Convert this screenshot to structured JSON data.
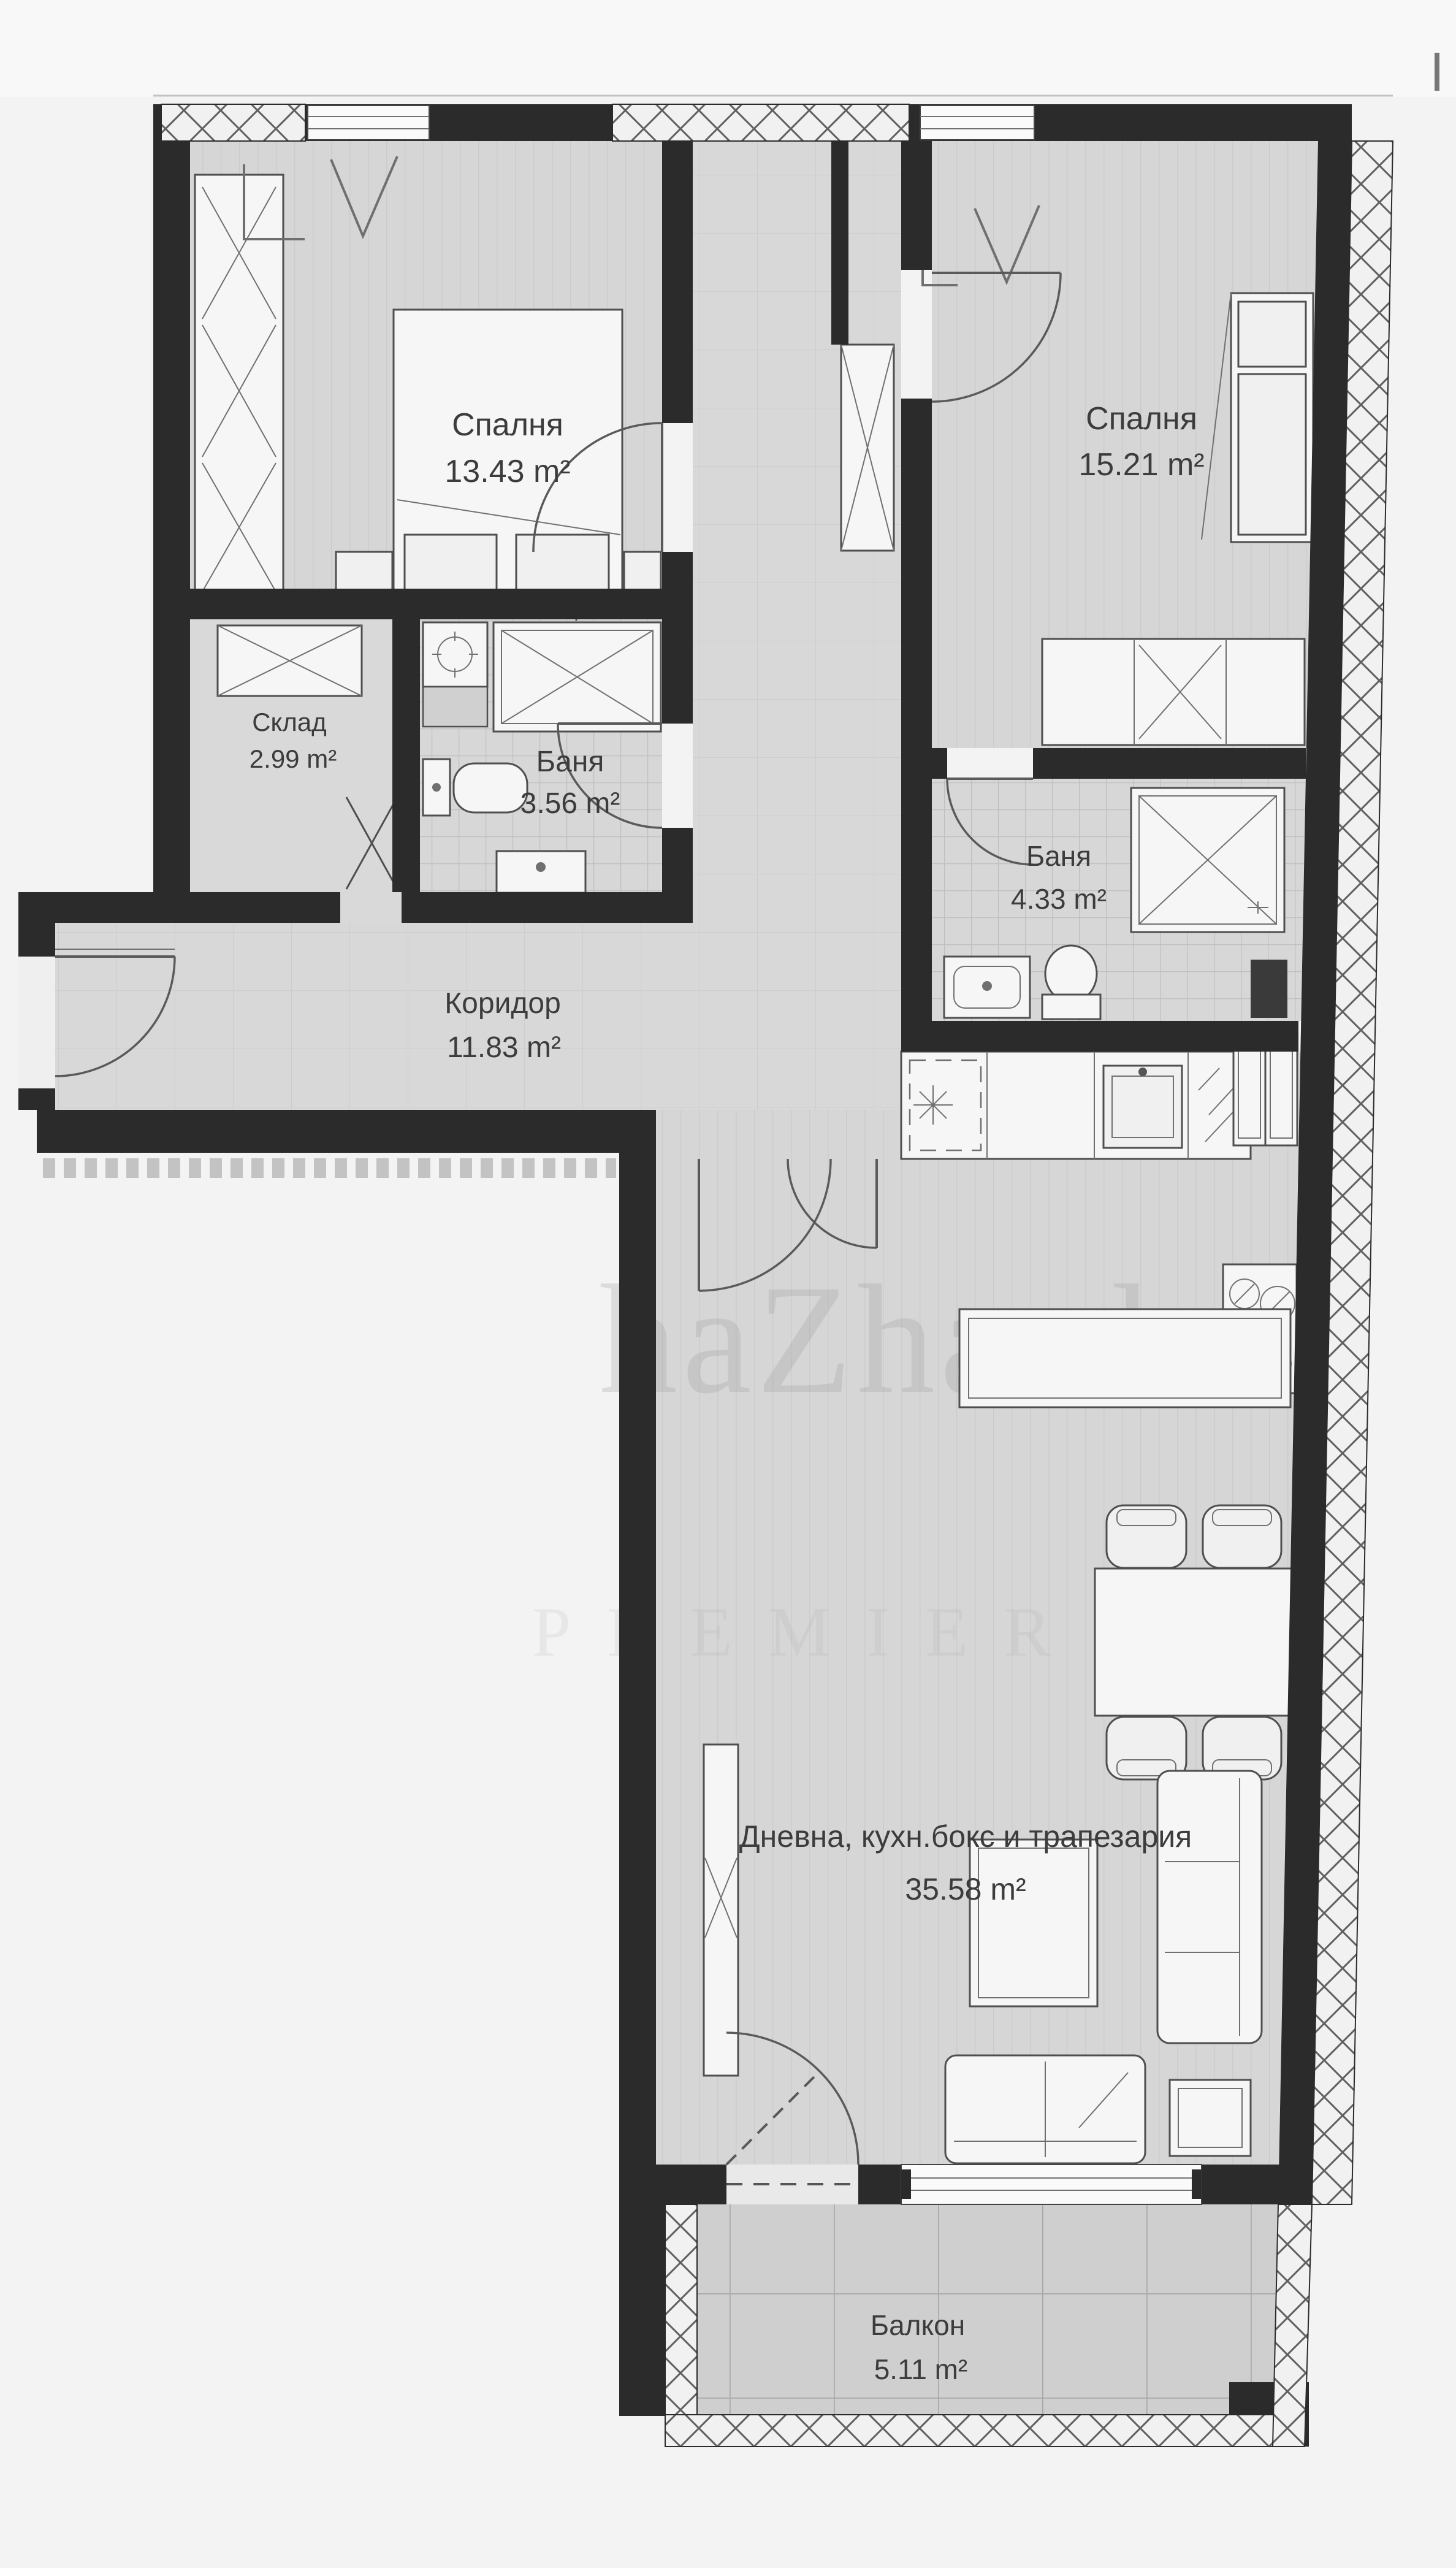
{
  "plan": {
    "type": "apartment-floor-plan",
    "language": "Bulgarian",
    "unit": "m²"
  },
  "rooms": {
    "bedroom1": {
      "name": "Спалня",
      "area": "13.43 m²"
    },
    "bedroom2": {
      "name": "Спалня",
      "area": "15.21 m²"
    },
    "storage": {
      "name": "Склад",
      "area": "2.99 m²"
    },
    "bath1": {
      "name": "Баня",
      "area": "3.56 m²"
    },
    "bath2": {
      "name": "Баня",
      "area": "4.33 m²"
    },
    "corridor": {
      "name": "Коридор",
      "area": "11.83 m²"
    },
    "living": {
      "name": "Дневна, кухн.бокс и трапезария",
      "area": "35.58 m²"
    },
    "balcony": {
      "name": "Балкон",
      "area": "5.11 m²"
    }
  },
  "watermark": {
    "primary": "haZhard",
    "secondary": "PREMIER"
  },
  "colors": {
    "wall": "#2b2b2b",
    "floor": "#d6d6d6",
    "tile_line": "#bfbfbf",
    "balcony_tile_line": "#a8a8a8",
    "furniture_fill": "#f0f0f0",
    "furniture_stroke": "#4f4f4f",
    "label_text": "#3c3c3c",
    "background": "#f3f3f3"
  },
  "icons": {
    "shower": "square-with-x-diagonals",
    "washing-machine": "square-with-circle-cross",
    "toilet": "bowl-with-cistern",
    "sink": "rect-with-faucet-dot",
    "stove": "four-burner-circles",
    "fridge": "double-door-rects",
    "radiator": "dashed-rect-with-star",
    "bed": "rect-with-pillows-and-fold",
    "wardrobe": "rect-with-x-braces",
    "dining-table": "rect-with-four-chairs",
    "sofa": "rounded-rect-with-cushions",
    "tv": "x-on-cabinet",
    "door": "quarter-circle-swing",
    "window": "triple-line-in-wall",
    "insulation": "diagonal-lattice-hatch"
  }
}
